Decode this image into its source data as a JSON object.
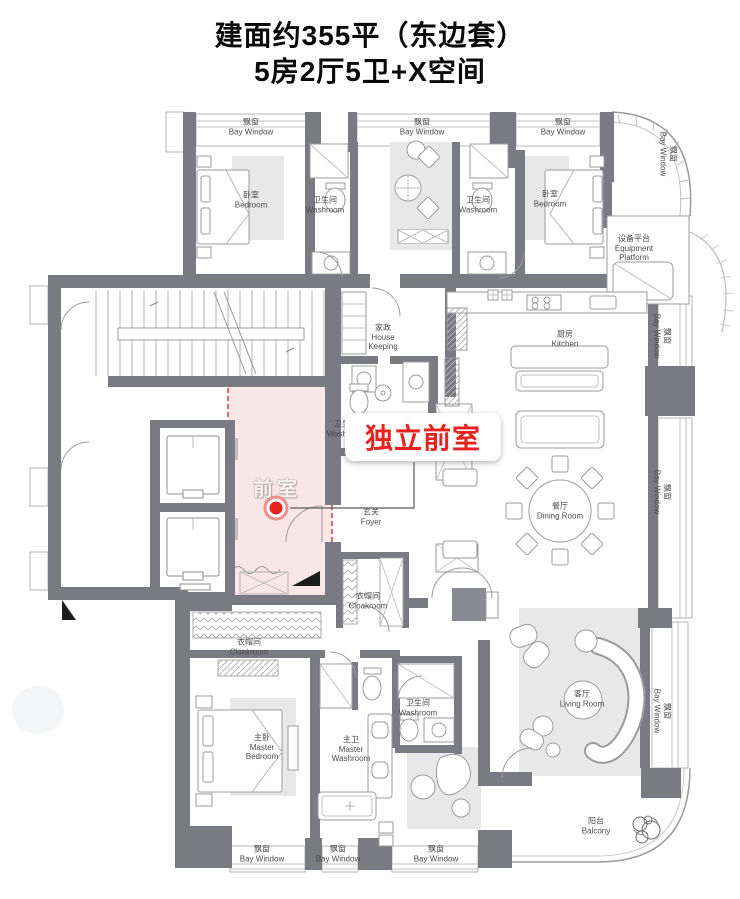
{
  "header": {
    "title": "建面约355平（东边套）",
    "subtitle": "5房2厅5卫+X空间"
  },
  "highlight": {
    "room": "前室",
    "callout": "独立前室"
  },
  "labels": {
    "bay_window": {
      "zh": "飘窗",
      "en": "Bay Window"
    },
    "bedroom": {
      "zh": "卧室",
      "en": "Bedroom"
    },
    "washroom": {
      "zh": "卫生间",
      "en": "Washroom"
    },
    "equipment_platform": {
      "zh": "设备平台",
      "en1": "Equipment",
      "en2": "Platform"
    },
    "housekeeping": {
      "zh": "家政",
      "en1": "House",
      "en2": "Keeping"
    },
    "kitchen": {
      "zh": "厨房",
      "en": "Kitchen"
    },
    "foyer": {
      "zh": "玄关",
      "en": "Foyer"
    },
    "dining": {
      "zh": "餐厅",
      "en": "Dining Room"
    },
    "cloakroom": {
      "zh": "衣帽间",
      "en": "Cloakroom"
    },
    "master_bedroom": {
      "zh": "主卧",
      "en1": "Master",
      "en2": "Bedroom"
    },
    "master_washroom": {
      "zh": "主卫",
      "en1": "Master",
      "en2": "Washroom"
    },
    "living": {
      "zh": "客厅",
      "en": "Living Room"
    },
    "balcony": {
      "zh": "阳台",
      "en": "Balcony"
    }
  },
  "colors": {
    "accent_red": "#e60012",
    "highlight_pink": "#f8e7e4",
    "wall_gray": "#7a7a82"
  }
}
